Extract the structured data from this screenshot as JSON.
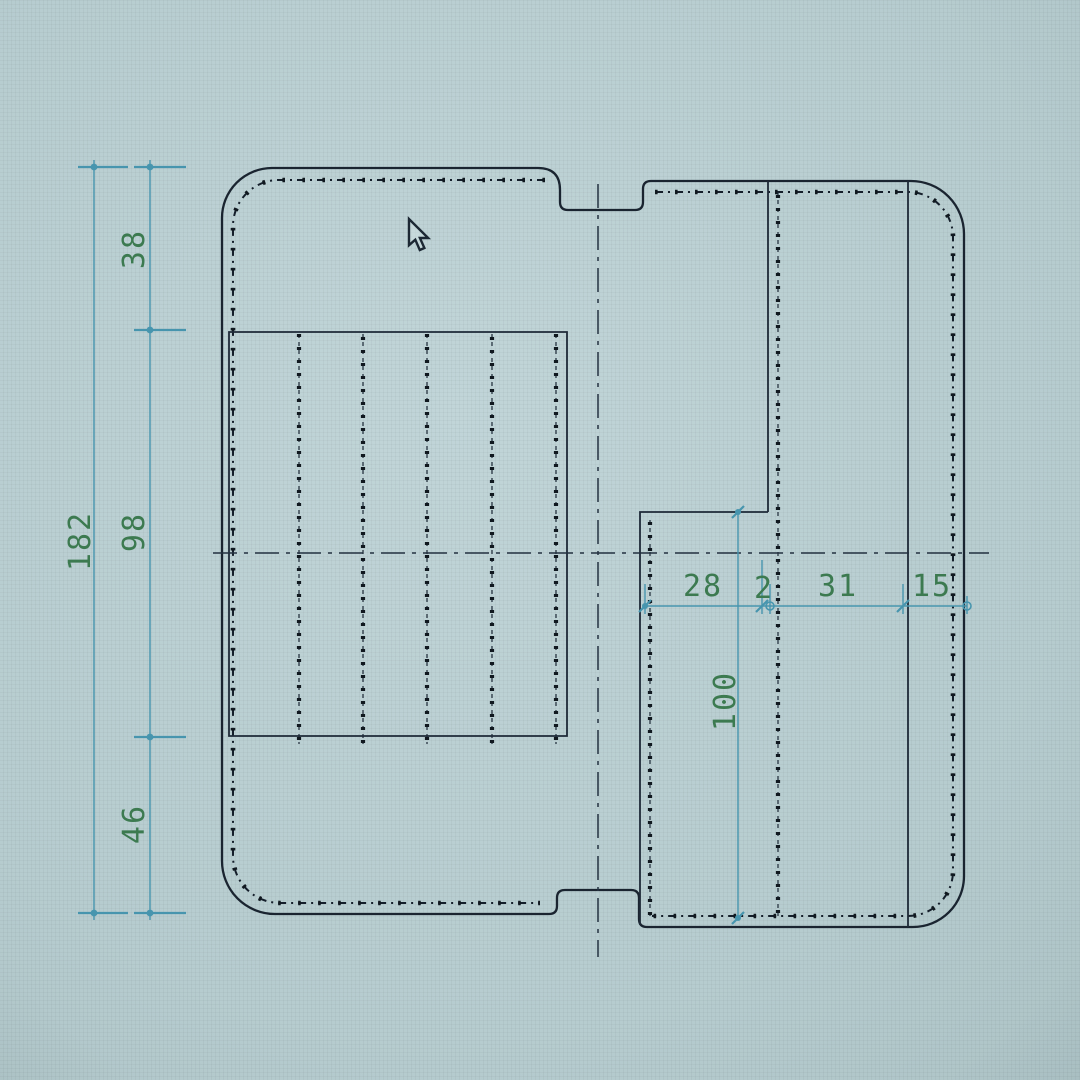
{
  "app": {
    "type": "cad-pattern-drawing-photo",
    "cursor": {
      "type": "arrow-pointer"
    }
  },
  "drawing": {
    "dimensions": {
      "left_total": "182",
      "left_top": "38",
      "left_middle": "98",
      "left_bottom": "46",
      "right_width_1": "28",
      "right_width_2": "2",
      "right_width_3": "31",
      "right_width_4": "15",
      "right_pocket_height": "100"
    },
    "colors": {
      "screen_background": "#b6cccf",
      "cut_line": "#1a2430",
      "dimension_line": "#4795ae",
      "dimension_label": "#3c7a50"
    }
  }
}
